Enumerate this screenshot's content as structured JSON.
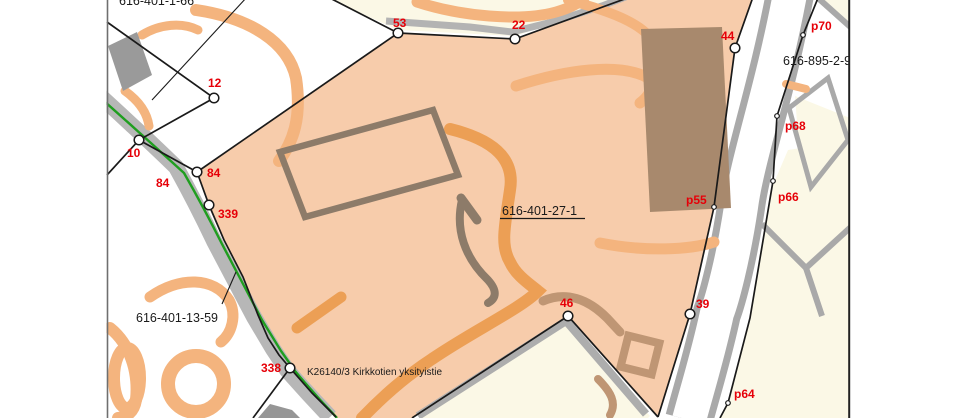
{
  "parcels": {
    "main": {
      "id": "616-401-27-1"
    },
    "north": {
      "id": "616-401-1-66"
    },
    "west": {
      "id": "616-401-13-59"
    },
    "north_east": {
      "id": "616-895-2-9"
    }
  },
  "road": {
    "name": "K26140/3 Kirkkotien yksityistie"
  },
  "points": [
    "53",
    "22",
    "44",
    "12",
    "10",
    "84",
    "84",
    "339",
    "338",
    "46",
    "39",
    "p70",
    "p68",
    "p66",
    "p55",
    "p64"
  ],
  "colors": {
    "parcel_fill": "#f7ccab",
    "field_cream": "#fbf8e6",
    "road_gray": "#b7b7b7",
    "road_edge_gray": "#a9a9a9",
    "private_road_green": "#1f9e1f",
    "building_fill_brown": "#a8896d",
    "building_outline_brown": "#8d7b69",
    "building_fill_gray": "#9a9a9a",
    "contour_orange": "#f4b47e",
    "contour_orange_dark": "#ec9f55",
    "boundary_black": "#1a1a1a",
    "point_label_red": "#e60008"
  }
}
